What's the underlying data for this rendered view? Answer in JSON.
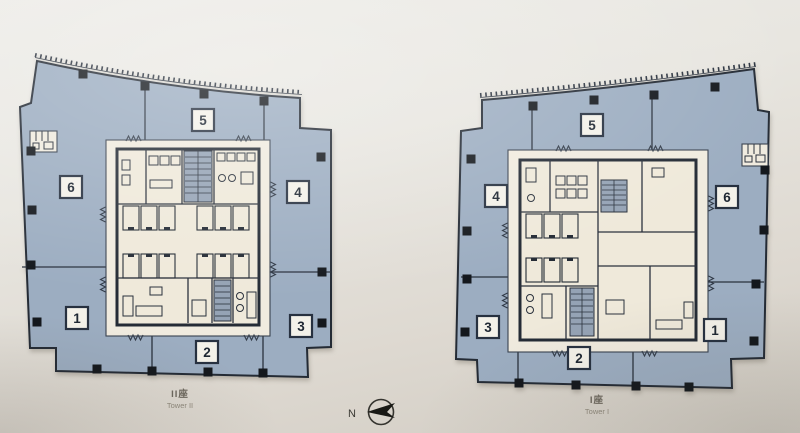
{
  "towers": [
    {
      "id": "tower-2",
      "label_cn": "II座",
      "label_en": "Tower II",
      "zones": {
        "top": "5",
        "left": "6",
        "right": "4",
        "bottom_left": "1",
        "bottom_center": "2",
        "bottom_right": "3"
      }
    },
    {
      "id": "tower-1",
      "label_cn": "I座",
      "label_en": "Tower I",
      "zones": {
        "top": "5",
        "left": "4",
        "right": "6",
        "bottom_left": "3",
        "bottom_center": "2",
        "bottom_right": "1"
      }
    }
  ],
  "compass": {
    "north_label": "N"
  },
  "colors": {
    "floor_plate": "#9cadc1",
    "outline": "#242b35",
    "core_fill": "#efe9da",
    "stair_fill": "#95a3b5",
    "background": "#e4e1da"
  }
}
